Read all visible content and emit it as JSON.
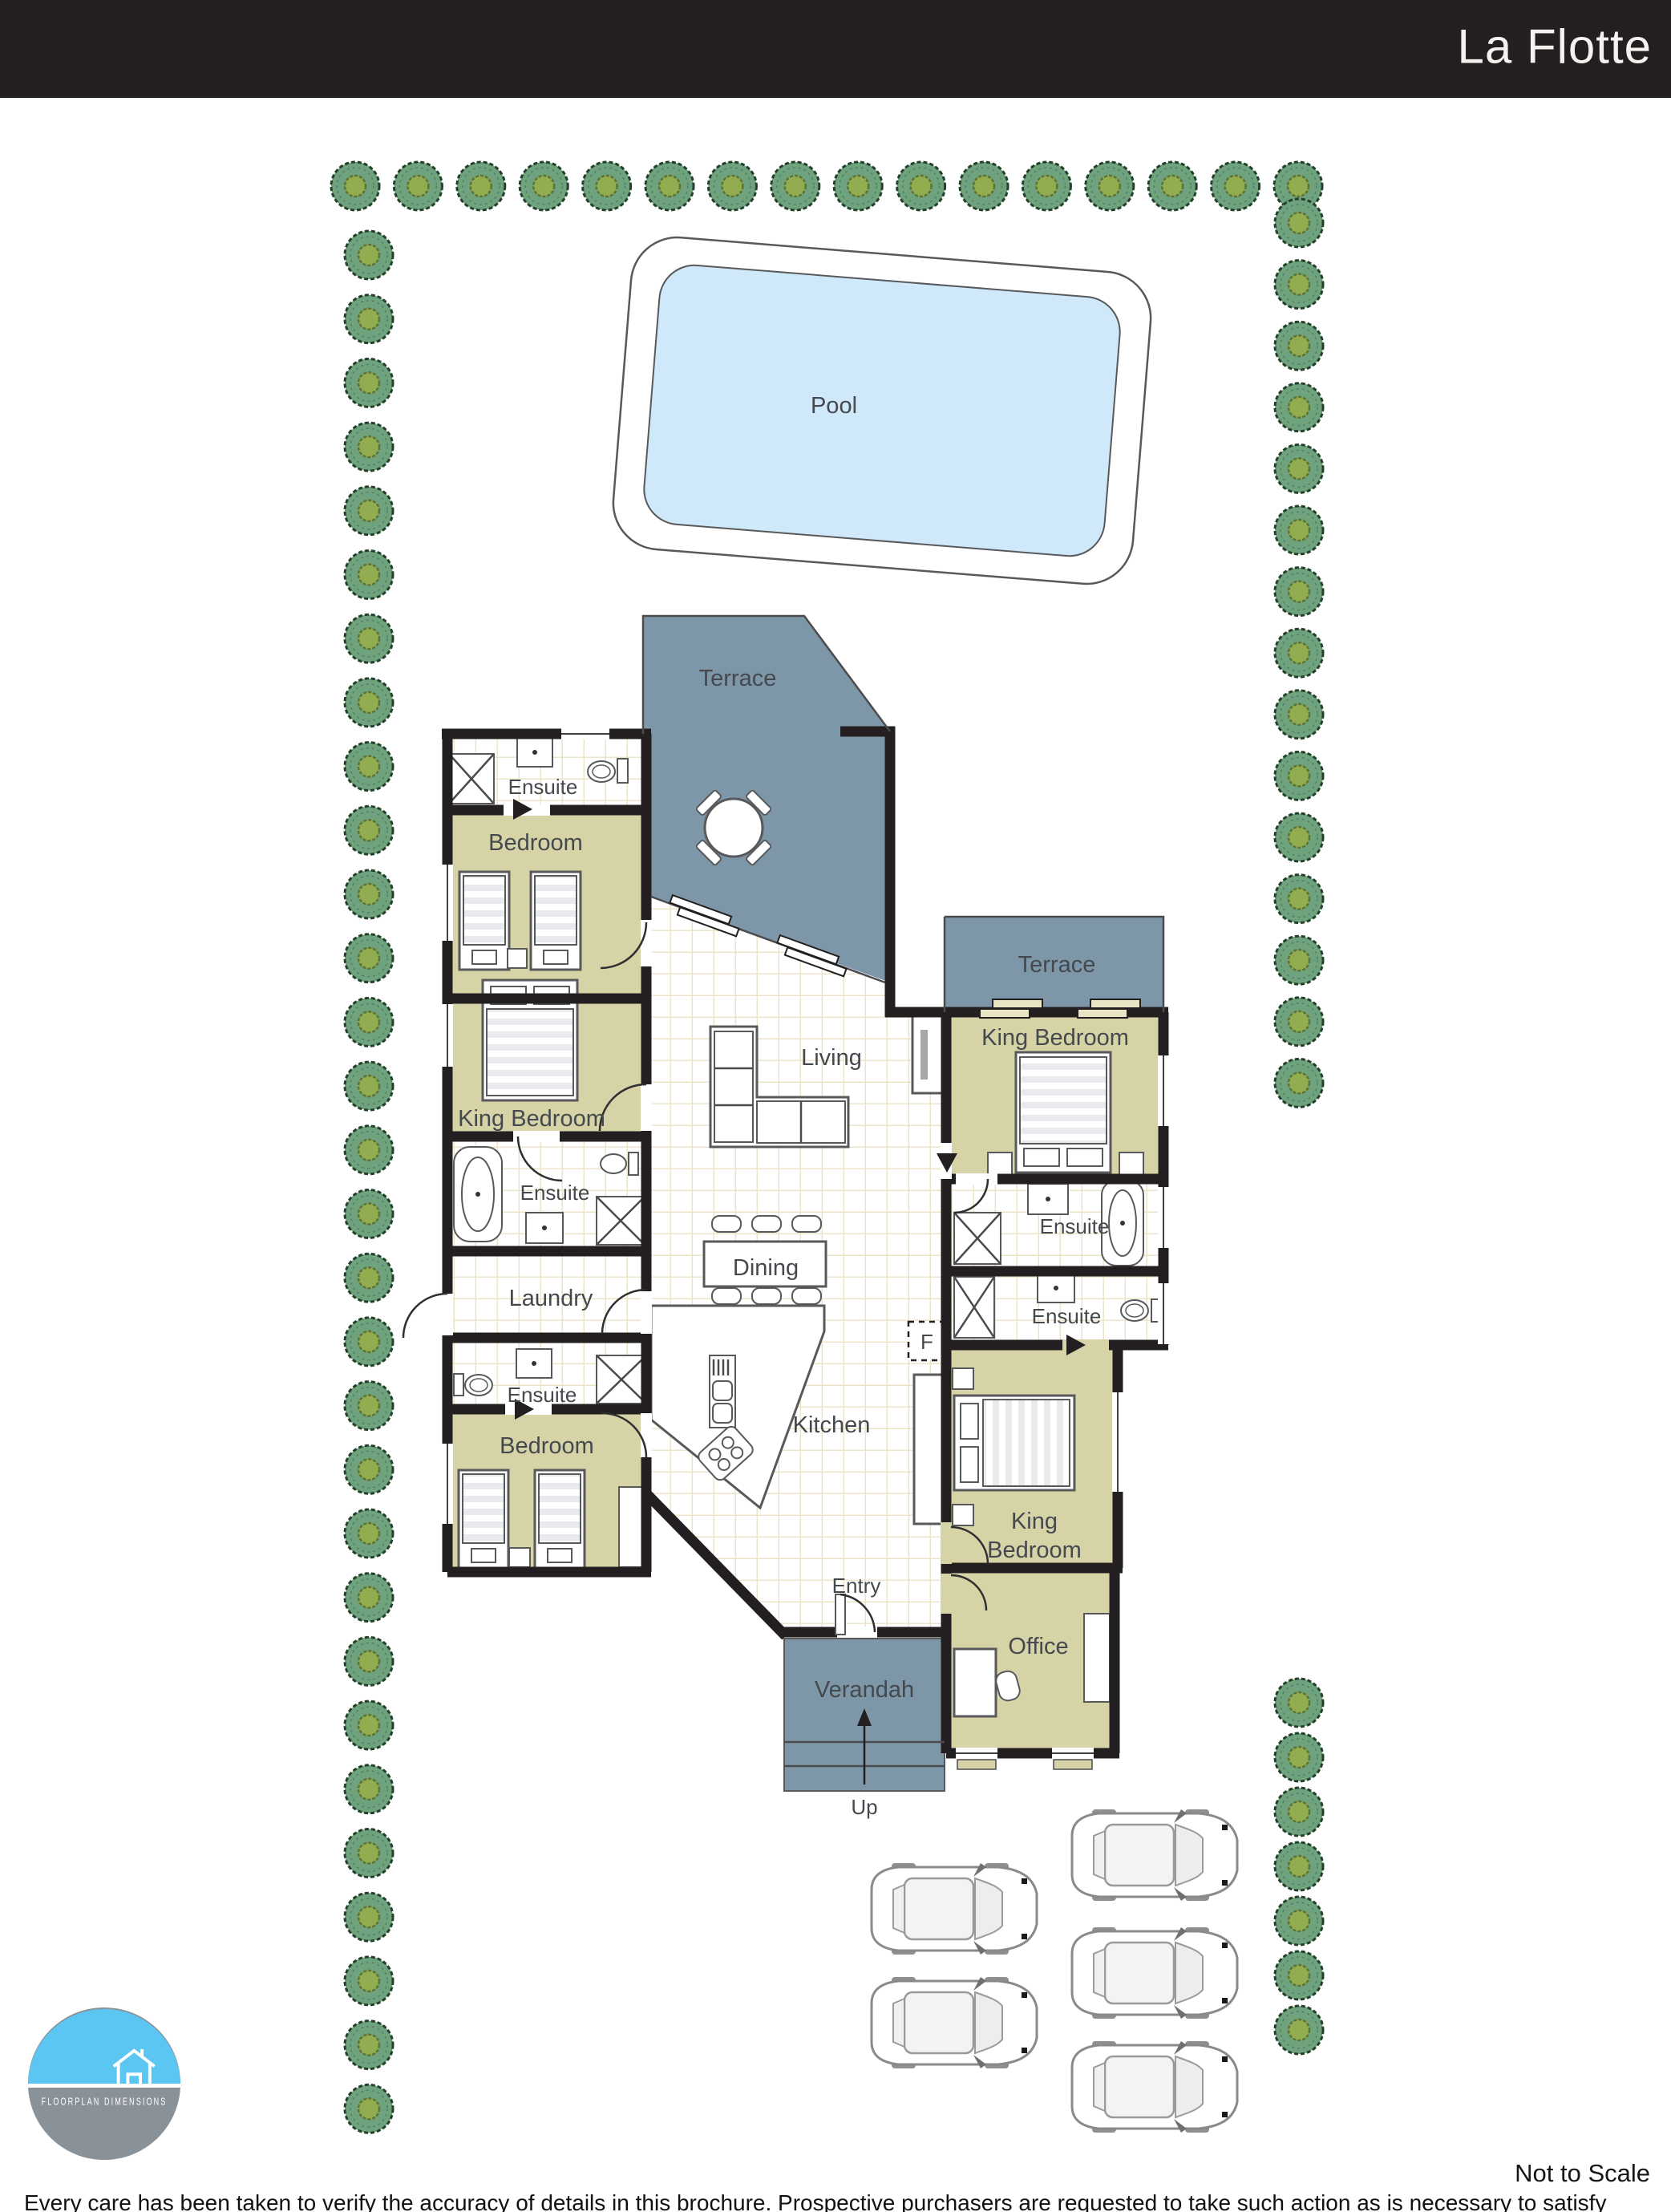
{
  "header": {
    "title": "La Flotte"
  },
  "rooms": {
    "pool": "Pool",
    "terrace_top": "Terrace",
    "terrace_right": "Terrace",
    "ensuite_top": "Ensuite",
    "bedroom_top": "Bedroom",
    "king_bedroom_left": "King Bedroom",
    "ensuite_left": "Ensuite",
    "laundry": "Laundry",
    "ensuite_lower": "Ensuite",
    "bedroom_lower": "Bedroom",
    "king_bedroom_right": "King Bedroom",
    "ensuite_right_upper": "Ensuite",
    "ensuite_right_lower": "Ensuite",
    "king_bedroom_bottom_line1": "King",
    "king_bedroom_bottom_line2": "Bedroom",
    "living": "Living",
    "dining": "Dining",
    "kitchen": "Kitchen",
    "entry": "Entry",
    "verandah": "Verandah",
    "office": "Office"
  },
  "annotations": {
    "up": "Up",
    "fridge": "F"
  },
  "logo": {
    "brand": "FLOORPLAN DIMENSIONS"
  },
  "footer": {
    "scale_note": "Not to Scale",
    "disclaimer": "Every care has been taken to verify the accuracy of details in this brochure. Prospective purchasers are requested to take such action as is necessary to satisfy themselves of any pertinent matters"
  },
  "colors": {
    "wall": "#231f20",
    "room_khaki": "#d6d3a7",
    "terrace_blue": "#7d97a9",
    "pool_water": "#cfe9fb",
    "tile_line": "#ece4c8",
    "tree_green": "#6fa37e",
    "tree_core": "#92ad50",
    "logo_blue": "#5ac6f1",
    "logo_gray": "#8a9299"
  }
}
